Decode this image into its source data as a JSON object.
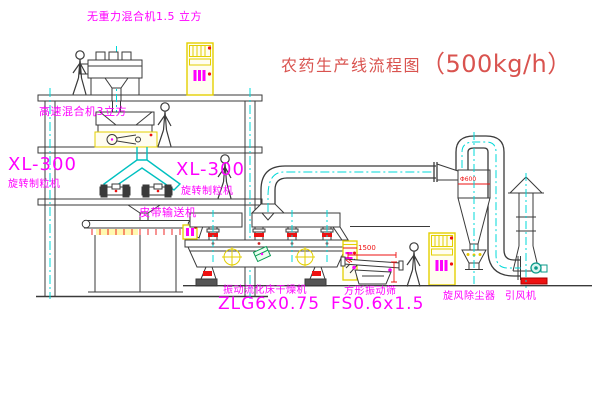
{
  "drawing": {
    "title": {
      "text": "农药生产线流程图",
      "capacity": "（500kg/h）"
    },
    "labels": {
      "gravity_mixer": "无重力混合机1.5 立方",
      "high_speed_mixer": "高速混合机3立方",
      "granulator_left_model": "XL-300",
      "granulator_left_name": "旋转制粒机",
      "granulator_center_model": "XL-300",
      "granulator_center_name": "旋转制粒机",
      "belt_conveyor": "皮带输送机",
      "dryer_name": "振动流化床干燥机",
      "dryer_model": "ZLG6x0.75",
      "screen_name": "方形振动筛",
      "screen_model": "FS0.6x1.5",
      "cyclone": "旋风除尘器",
      "fan": "引风机"
    },
    "dimensions": {
      "screen_length": "1500",
      "cyclone_diameter": "Φ600"
    },
    "colors": {
      "line": "#3a3a3a",
      "centerline": "#00d8d8",
      "highlight_yellow": "#e3cf00",
      "label_magenta": "#ff00ff",
      "accent_red": "#ee1111",
      "title_red": "#d9534f",
      "detail_green": "#0a9a55"
    }
  }
}
